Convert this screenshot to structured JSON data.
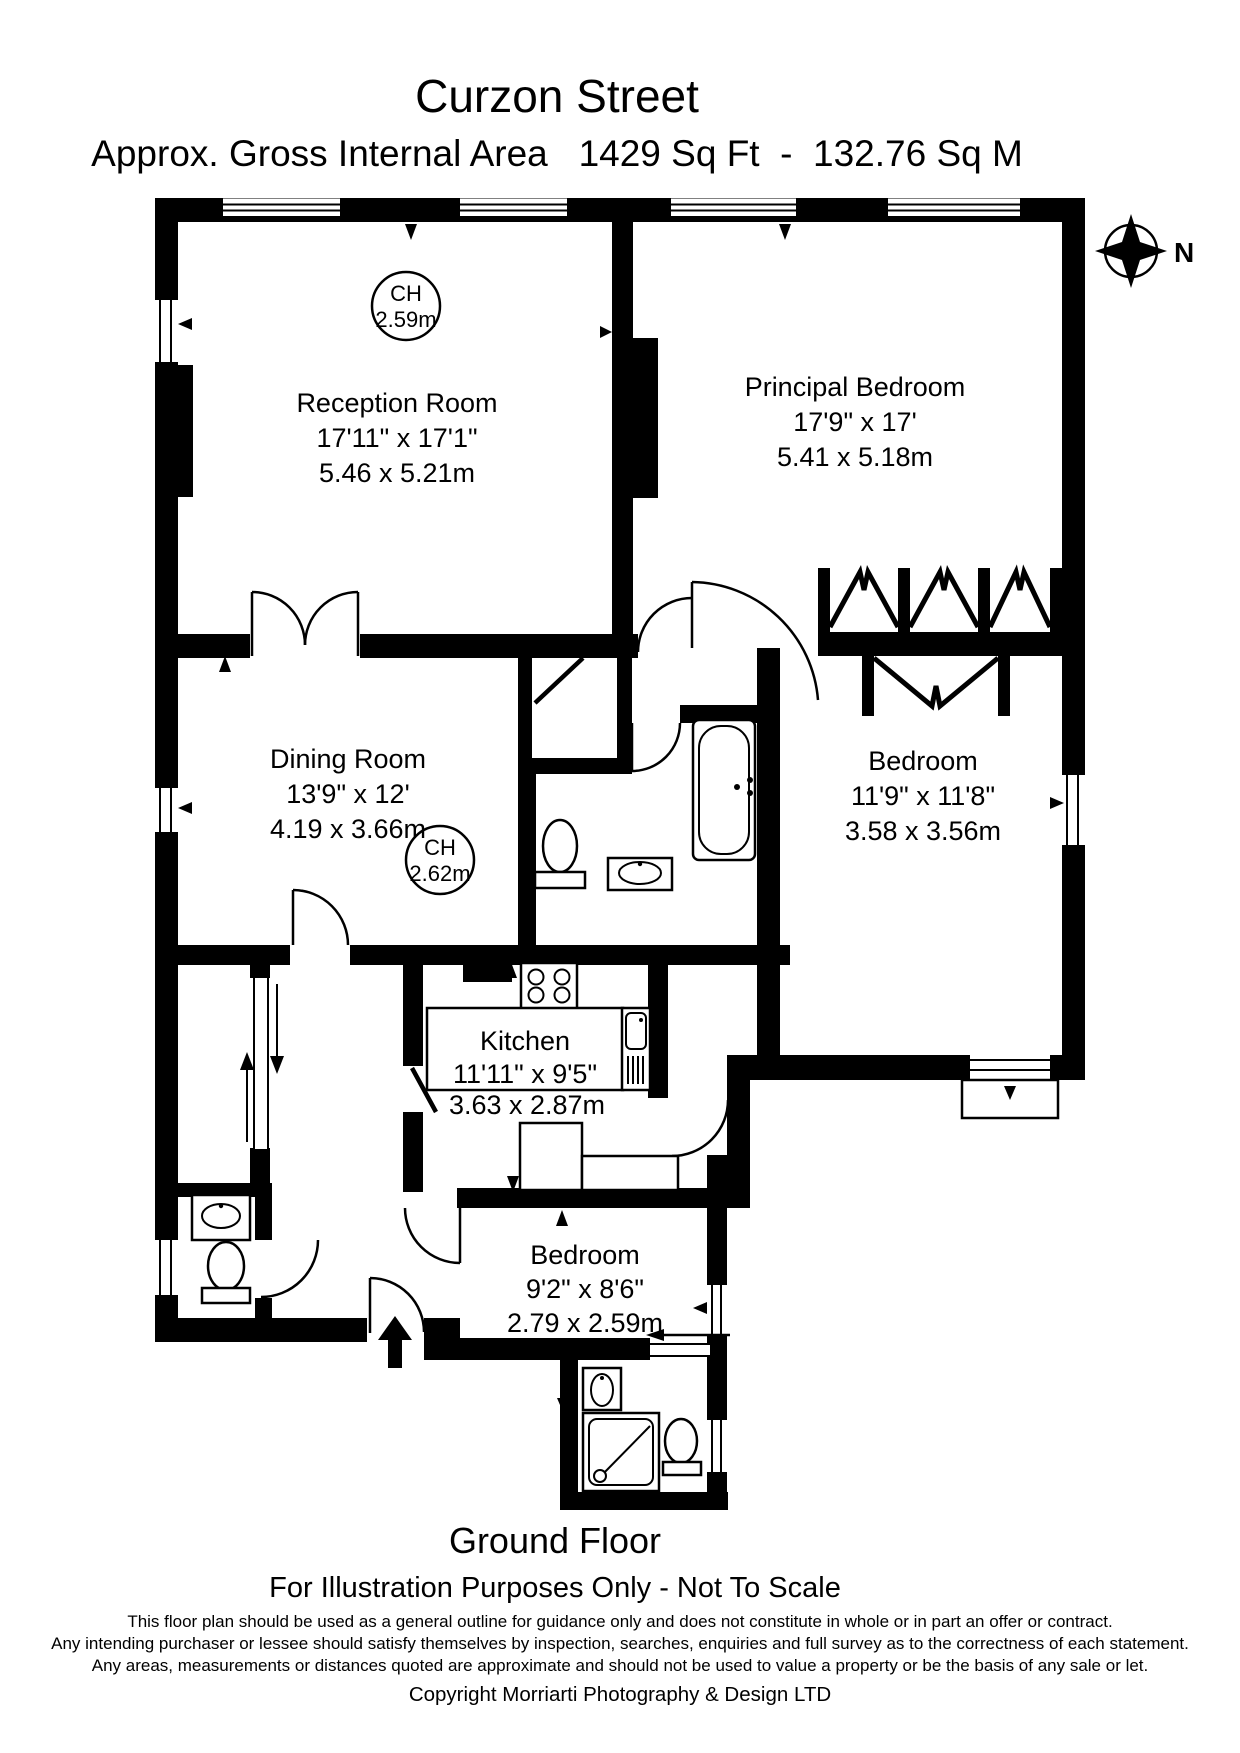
{
  "header": {
    "title": "Curzon Street",
    "subtitle": "Approx. Gross Internal Area   1429 Sq Ft  -  132.76 Sq M"
  },
  "compass": {
    "north_label": "N"
  },
  "rooms": {
    "reception": {
      "name": "Reception Room",
      "imperial": "17'11\" x 17'1\"",
      "metric": "5.46 x 5.21m",
      "ceiling": {
        "label": "CH",
        "height": "2.59m"
      }
    },
    "principal_bedroom": {
      "name": "Principal Bedroom",
      "imperial": "17'9\" x 17'",
      "metric": "5.41 x 5.18m"
    },
    "dining": {
      "name": "Dining Room",
      "imperial": "13'9\" x 12'",
      "metric": "4.19 x 3.66m",
      "ceiling": {
        "label": "CH",
        "height": "2.62m"
      }
    },
    "bedroom2": {
      "name": "Bedroom",
      "imperial": "11'9\" x 11'8\"",
      "metric": "3.58 x 3.56m"
    },
    "kitchen": {
      "name": "Kitchen",
      "imperial": "11'11\" x 9'5\"",
      "metric": "3.63 x 2.87m"
    },
    "bedroom3": {
      "name": "Bedroom",
      "imperial": "9'2\" x 8'6\"",
      "metric": "2.79 x 2.59m"
    }
  },
  "footer": {
    "floor_label": "Ground Floor",
    "scale_note": "For Illustration Purposes Only - Not To Scale",
    "disclaimer_line1": "This floor plan should be used as a general outline for guidance only and does not constitute in whole or in part an offer or contract.",
    "disclaimer_line2": "Any intending purchaser or lessee should satisfy themselves by inspection, searches, enquiries and full survey as to the correctness of each statement.",
    "disclaimer_line3": "Any areas, measurements or distances quoted are approximate and should not be used to value a property or be the basis of any sale or let.",
    "copyright": "Copyright Morriarti Photography & Design LTD"
  },
  "colors": {
    "ink": "#000000",
    "background": "#ffffff"
  }
}
